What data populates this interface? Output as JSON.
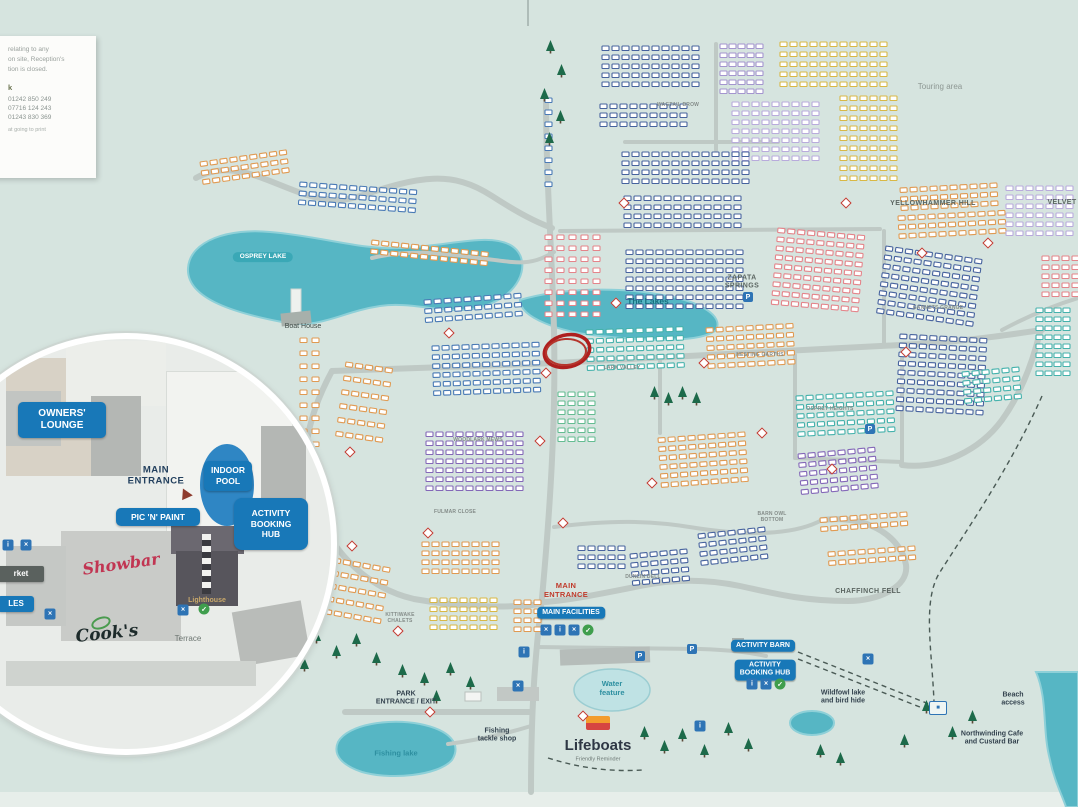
{
  "title": "Holiday park site map",
  "colors": {
    "accent_blue": "#1878b8",
    "teal_lake": "#56b6c4",
    "sea": "#57b4c4",
    "road": "#bfc9c5",
    "red_highlight": "#ae1f1e",
    "tree_green": "#1d6a4a",
    "navy": "#47639e",
    "blue": "#4a7ab5",
    "teal": "#45b2ac",
    "mint": "#64bd92",
    "orange": "#e09a52",
    "gold": "#d9b845",
    "pink": "#e4848a",
    "lilac": "#a495cf",
    "lavender": "#b9abdc",
    "purple": "#8468b8"
  },
  "info_card": {
    "lines": [
      "relating to any",
      "on site, Reception's",
      "tion is closed."
    ],
    "heading": "k",
    "phones": [
      "01242 850 249",
      "07716 124 243",
      "01243 830 369"
    ],
    "footer": "at going to print"
  },
  "inset": {
    "owners_lounge": "OWNERS'\nLOUNGE",
    "main_entrance": "MAIN\nENTRANCE",
    "indoor_pool": "INDOOR\nPOOL",
    "pic_n_paint": "PIC 'N' PAINT",
    "activity_hub": "ACTIVITY\nBOOKING\nHUB",
    "showbar": "Showbar",
    "lighthouse": "Lighthouse",
    "cooks": "Cook's",
    "terrace": "Terrace",
    "market": "rket",
    "ales": "LES"
  },
  "map_labels": [
    {
      "t": "Touring area",
      "x": 940,
      "y": 87,
      "s": "arealt"
    },
    {
      "t": "YELLOWHAMMER HILL",
      "x": 933,
      "y": 204,
      "s": "area"
    },
    {
      "t": "VELVET",
      "x": 1062,
      "y": 203,
      "s": "area"
    },
    {
      "t": "ZAPATA\nSPRINGS",
      "x": 742,
      "y": 283,
      "s": "area"
    },
    {
      "t": "WAGTAIL BROW",
      "x": 678,
      "y": 105,
      "s": "road"
    },
    {
      "t": "GANNETS GRANGE",
      "x": 938,
      "y": 308,
      "s": "road"
    },
    {
      "t": "LARK VALLEY",
      "x": 622,
      "y": 368,
      "s": "road"
    },
    {
      "t": "NESTING GARTHS",
      "x": 760,
      "y": 355,
      "s": "road"
    },
    {
      "t": "OSPREY HEIGHTS",
      "x": 830,
      "y": 409,
      "s": "road"
    },
    {
      "t": "BARN OWL\nBOTTOM",
      "x": 772,
      "y": 517,
      "s": "road"
    },
    {
      "t": "CHAFFINCH FELL",
      "x": 868,
      "y": 592,
      "s": "area"
    },
    {
      "t": "DUNLIN DELL",
      "x": 643,
      "y": 577,
      "s": "road"
    },
    {
      "t": "KITTIWAKE\nCHALETS",
      "x": 400,
      "y": 618,
      "s": "road"
    },
    {
      "t": "FULMAR CLOSE",
      "x": 455,
      "y": 512,
      "s": "road"
    },
    {
      "t": "WOODLARK MEWS",
      "x": 478,
      "y": 440,
      "s": "road"
    },
    {
      "t": "OSPREY LAKE",
      "x": 263,
      "y": 257,
      "s": "pillteal"
    },
    {
      "t": "The Lakes",
      "x": 648,
      "y": 301,
      "s": "lake"
    },
    {
      "t": "Boat House",
      "x": 303,
      "y": 327,
      "s": "place"
    },
    {
      "t": "MAIN\nENTRANCE",
      "x": 566,
      "y": 590,
      "s": "red"
    },
    {
      "t": "MAIN FACILITIES",
      "x": 571,
      "y": 613,
      "s": "pill"
    },
    {
      "t": "PARK\nENTRANCE / EXIT",
      "x": 406,
      "y": 699,
      "s": "pbold"
    },
    {
      "t": "Fishing lake",
      "x": 396,
      "y": 753,
      "s": "teal"
    },
    {
      "t": "Fishing\ntackle shop",
      "x": 497,
      "y": 736,
      "s": "pbold"
    },
    {
      "t": "Water\nfeature",
      "x": 612,
      "y": 688,
      "s": "teal"
    },
    {
      "t": "Lifeboats",
      "x": 598,
      "y": 746,
      "s": "big"
    },
    {
      "t": "Friendly Reminder",
      "x": 598,
      "y": 760,
      "s": "tiny"
    },
    {
      "t": "ACTIVITY BARN",
      "x": 763,
      "y": 646,
      "s": "pill"
    },
    {
      "t": "ACTIVITY\nBOOKING HUB",
      "x": 765,
      "y": 670,
      "s": "pill"
    },
    {
      "t": "Wildfowl lake\nand bird hide",
      "x": 843,
      "y": 698,
      "s": "pbold"
    },
    {
      "t": "Beach\naccess",
      "x": 1013,
      "y": 700,
      "s": "pbold"
    },
    {
      "t": "Northwinding Cafe\nand Custard Bar",
      "x": 992,
      "y": 739,
      "s": "pbold"
    }
  ],
  "clusters": [
    {
      "x": 602,
      "y": 46,
      "c": 10,
      "r": 5,
      "k": "navy"
    },
    {
      "x": 600,
      "y": 104,
      "c": 9,
      "r": 3,
      "k": "navy"
    },
    {
      "x": 720,
      "y": 44,
      "c": 5,
      "r": 6,
      "k": "lilac",
      "gx": 9
    },
    {
      "x": 732,
      "y": 102,
      "c": 9,
      "r": 7,
      "k": "lavender"
    },
    {
      "x": 780,
      "y": 42,
      "c": 11,
      "r": 5,
      "k": "gold",
      "gy": 10
    },
    {
      "x": 840,
      "y": 96,
      "c": 6,
      "r": 9,
      "k": "gold",
      "gy": 10
    },
    {
      "x": 622,
      "y": 152,
      "c": 13,
      "r": 4,
      "k": "navy"
    },
    {
      "x": 624,
      "y": 196,
      "c": 12,
      "r": 4,
      "k": "navy"
    },
    {
      "x": 900,
      "y": 188,
      "c": 10,
      "r": 3,
      "k": "orange",
      "a": -3
    },
    {
      "x": 898,
      "y": 216,
      "c": 11,
      "r": 3,
      "k": "orange",
      "a": -3
    },
    {
      "x": 1006,
      "y": 186,
      "c": 7,
      "r": 6,
      "k": "lavender"
    },
    {
      "x": 1042,
      "y": 256,
      "c": 4,
      "r": 5,
      "k": "pink"
    },
    {
      "x": 1036,
      "y": 308,
      "c": 4,
      "r": 8,
      "k": "teal",
      "gx": 9
    },
    {
      "x": 886,
      "y": 246,
      "c": 10,
      "r": 8,
      "k": "navy",
      "a": 8
    },
    {
      "x": 545,
      "y": 235,
      "c": 5,
      "r": 8,
      "k": "pink",
      "gx": 12,
      "gy": 11
    },
    {
      "x": 626,
      "y": 250,
      "c": 12,
      "r": 7,
      "k": "navy"
    },
    {
      "x": 778,
      "y": 228,
      "c": 9,
      "r": 9,
      "k": "pink",
      "a": 5
    },
    {
      "x": 200,
      "y": 162,
      "c": 9,
      "r": 3,
      "k": "orange",
      "a": -8
    },
    {
      "x": 300,
      "y": 182,
      "c": 12,
      "r": 3,
      "k": "blue",
      "a": 4
    },
    {
      "x": 372,
      "y": 240,
      "c": 12,
      "r": 2,
      "k": "orange",
      "a": 6
    },
    {
      "x": 424,
      "y": 300,
      "c": 10,
      "r": 3,
      "k": "blue",
      "a": -4
    },
    {
      "x": 586,
      "y": 330,
      "c": 10,
      "r": 5,
      "k": "teal",
      "a": -2
    },
    {
      "x": 706,
      "y": 328,
      "c": 9,
      "r": 5,
      "k": "orange",
      "a": -3
    },
    {
      "x": 796,
      "y": 396,
      "c": 10,
      "r": 5,
      "k": "teal",
      "a": -3
    },
    {
      "x": 900,
      "y": 334,
      "c": 9,
      "r": 9,
      "k": "navy",
      "a": 3
    },
    {
      "x": 962,
      "y": 372,
      "c": 6,
      "r": 4,
      "k": "teal",
      "a": -5
    },
    {
      "x": 432,
      "y": 346,
      "c": 11,
      "r": 6,
      "k": "blue",
      "a": -2
    },
    {
      "x": 426,
      "y": 432,
      "c": 10,
      "r": 7,
      "k": "purple"
    },
    {
      "x": 300,
      "y": 338,
      "c": 2,
      "r": 10,
      "k": "orange",
      "gx": 12,
      "gy": 13
    },
    {
      "x": 346,
      "y": 362,
      "c": 5,
      "r": 6,
      "k": "orange",
      "a": 8,
      "gy": 14
    },
    {
      "x": 558,
      "y": 392,
      "c": 4,
      "r": 6,
      "k": "mint"
    },
    {
      "x": 658,
      "y": 438,
      "c": 9,
      "r": 6,
      "k": "orange",
      "a": -4
    },
    {
      "x": 798,
      "y": 454,
      "c": 8,
      "r": 5,
      "k": "purple",
      "a": -5
    },
    {
      "x": 820,
      "y": 518,
      "c": 9,
      "r": 2,
      "k": "orange",
      "a": -4
    },
    {
      "x": 828,
      "y": 552,
      "c": 9,
      "r": 2,
      "k": "orange",
      "a": -4
    },
    {
      "x": 698,
      "y": 534,
      "c": 7,
      "r": 4,
      "k": "navy",
      "a": -6
    },
    {
      "x": 578,
      "y": 546,
      "c": 5,
      "r": 3,
      "k": "navy"
    },
    {
      "x": 630,
      "y": 554,
      "c": 6,
      "r": 4,
      "k": "navy",
      "a": -5
    },
    {
      "x": 422,
      "y": 542,
      "c": 8,
      "r": 4,
      "k": "orange"
    },
    {
      "x": 430,
      "y": 598,
      "c": 7,
      "r": 4,
      "k": "gold"
    },
    {
      "x": 514,
      "y": 600,
      "c": 3,
      "r": 4,
      "k": "orange"
    },
    {
      "x": 334,
      "y": 558,
      "c": 6,
      "r": 5,
      "k": "orange",
      "a": 10,
      "gy": 13
    },
    {
      "x": 545,
      "y": 98,
      "c": 1,
      "r": 8,
      "k": "blue",
      "gy": 12
    }
  ],
  "trees": [
    [
      546,
      40
    ],
    [
      557,
      64
    ],
    [
      540,
      88
    ],
    [
      556,
      110
    ],
    [
      545,
      132
    ],
    [
      650,
      386
    ],
    [
      664,
      392
    ],
    [
      678,
      386
    ],
    [
      692,
      392
    ],
    [
      312,
      630
    ],
    [
      332,
      645
    ],
    [
      352,
      633
    ],
    [
      300,
      658
    ],
    [
      372,
      652
    ],
    [
      398,
      664
    ],
    [
      420,
      672
    ],
    [
      446,
      662
    ],
    [
      466,
      676
    ],
    [
      432,
      690
    ],
    [
      640,
      726
    ],
    [
      660,
      740
    ],
    [
      678,
      728
    ],
    [
      700,
      744
    ],
    [
      724,
      722
    ],
    [
      744,
      738
    ],
    [
      900,
      734
    ],
    [
      922,
      700
    ],
    [
      948,
      726
    ],
    [
      968,
      710
    ],
    [
      816,
      744
    ],
    [
      836,
      752
    ]
  ],
  "icons": [
    {
      "k": "P",
      "x": 748,
      "y": 297,
      "ch": "P"
    },
    {
      "k": "P",
      "x": 870,
      "y": 429,
      "ch": "P"
    },
    {
      "k": "P",
      "x": 640,
      "y": 656,
      "ch": "P"
    },
    {
      "k": "P",
      "x": 692,
      "y": 649,
      "ch": "P"
    },
    {
      "k": "sq",
      "x": 546,
      "y": 630,
      "ch": "×"
    },
    {
      "k": "sq",
      "x": 560,
      "y": 630,
      "ch": "i"
    },
    {
      "k": "sq",
      "x": 574,
      "y": 630,
      "ch": "×"
    },
    {
      "k": "grn",
      "x": 588,
      "y": 630,
      "ch": "✓"
    },
    {
      "k": "sq",
      "x": 524,
      "y": 652,
      "ch": "i"
    },
    {
      "k": "sq",
      "x": 518,
      "y": 686,
      "ch": "×"
    },
    {
      "k": "sq",
      "x": 700,
      "y": 726,
      "ch": "i"
    },
    {
      "k": "sq",
      "x": 868,
      "y": 659,
      "ch": "×"
    },
    {
      "k": "sq",
      "x": 752,
      "y": 684,
      "ch": "i"
    },
    {
      "k": "sq",
      "x": 766,
      "y": 684,
      "ch": "×"
    },
    {
      "k": "grn",
      "x": 780,
      "y": 684,
      "ch": "✓"
    },
    {
      "k": "fun",
      "x": 938,
      "y": 708,
      "ch": "■"
    },
    {
      "k": "sq",
      "x": 50,
      "y": 614,
      "ch": "×"
    },
    {
      "k": "sq",
      "x": 183,
      "y": 610,
      "ch": "×"
    },
    {
      "k": "grn",
      "x": 204,
      "y": 609,
      "ch": "✓"
    },
    {
      "k": "sq",
      "x": 8,
      "y": 545,
      "ch": "i"
    },
    {
      "k": "sq",
      "x": 26,
      "y": 545,
      "ch": "×"
    },
    {
      "k": "red",
      "x": 352,
      "y": 546
    },
    {
      "k": "red",
      "x": 546,
      "y": 373
    },
    {
      "k": "red",
      "x": 616,
      "y": 303
    },
    {
      "k": "red",
      "x": 704,
      "y": 363
    },
    {
      "k": "red",
      "x": 832,
      "y": 469
    },
    {
      "k": "red",
      "x": 906,
      "y": 352
    },
    {
      "k": "red",
      "x": 652,
      "y": 483
    },
    {
      "k": "red",
      "x": 563,
      "y": 523
    },
    {
      "k": "red",
      "x": 449,
      "y": 333
    },
    {
      "k": "red",
      "x": 762,
      "y": 433
    },
    {
      "k": "red",
      "x": 922,
      "y": 253
    },
    {
      "k": "red",
      "x": 988,
      "y": 243
    },
    {
      "k": "red",
      "x": 846,
      "y": 203
    },
    {
      "k": "red",
      "x": 624,
      "y": 203
    },
    {
      "k": "red",
      "x": 540,
      "y": 441
    },
    {
      "k": "red",
      "x": 428,
      "y": 533
    },
    {
      "k": "red",
      "x": 398,
      "y": 631
    },
    {
      "k": "red",
      "x": 430,
      "y": 712
    },
    {
      "k": "red",
      "x": 583,
      "y": 716
    },
    {
      "k": "red",
      "x": 350,
      "y": 452
    }
  ]
}
